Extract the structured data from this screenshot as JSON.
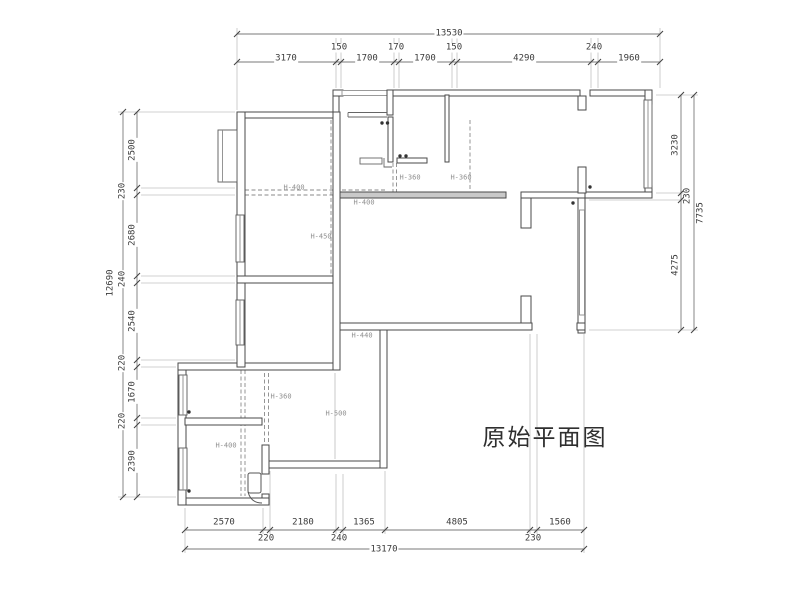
{
  "title": {
    "text": "原始平面图"
  },
  "dimensions": {
    "top": {
      "overall": "13530",
      "segments": [
        "3170",
        "150",
        "1700",
        "170",
        "1700",
        "150",
        "4290",
        "240",
        "1960"
      ]
    },
    "left": {
      "overall": "12690",
      "segments": [
        "2500",
        "230",
        "2680",
        "240",
        "2540",
        "220",
        "1670",
        "220",
        "2390"
      ]
    },
    "right": {
      "overall": "7735",
      "segments": [
        "3230",
        "230",
        "4275"
      ]
    },
    "bottom": {
      "overall": "13170",
      "segments": [
        "2570",
        "220",
        "2180",
        "240",
        "1365",
        "4805",
        "230",
        "1560"
      ]
    }
  },
  "beam_labels": [
    "H-400",
    "H-450",
    "H-360",
    "H-360",
    "H-400",
    "H-440",
    "H-360",
    "H-500",
    "H-400"
  ],
  "colors": {
    "wall_line": "#4a4a4a",
    "dim_line": "#7a7a7a",
    "dim_text": "#3a3a3a",
    "beam_text": "#8f8f8f",
    "wall_fill_light": "#c9c9c9"
  },
  "placed_texts": [
    {
      "t": "13530",
      "x": 449,
      "y": 34,
      "rot": 0,
      "kind": "dim"
    },
    {
      "t": "3170",
      "x": 286,
      "y": 59,
      "rot": 0,
      "kind": "dim"
    },
    {
      "t": "150",
      "x": 339,
      "y": 48,
      "rot": 0,
      "kind": "dim"
    },
    {
      "t": "1700",
      "x": 367,
      "y": 59,
      "rot": 0,
      "kind": "dim"
    },
    {
      "t": "170",
      "x": 396,
      "y": 48,
      "rot": 0,
      "kind": "dim"
    },
    {
      "t": "1700",
      "x": 425,
      "y": 59,
      "rot": 0,
      "kind": "dim"
    },
    {
      "t": "150",
      "x": 454,
      "y": 48,
      "rot": 0,
      "kind": "dim"
    },
    {
      "t": "4290",
      "x": 524,
      "y": 59,
      "rot": 0,
      "kind": "dim"
    },
    {
      "t": "240",
      "x": 594,
      "y": 48,
      "rot": 0,
      "kind": "dim"
    },
    {
      "t": "1960",
      "x": 629,
      "y": 59,
      "rot": 0,
      "kind": "dim"
    },
    {
      "t": "12690",
      "x": 111,
      "y": 283,
      "rot": 1,
      "kind": "dim"
    },
    {
      "t": "2500",
      "x": 133,
      "y": 150,
      "rot": 1,
      "kind": "dim"
    },
    {
      "t": "230",
      "x": 123,
      "y": 191,
      "rot": 1,
      "kind": "dim"
    },
    {
      "t": "2680",
      "x": 133,
      "y": 235,
      "rot": 1,
      "kind": "dim"
    },
    {
      "t": "240",
      "x": 123,
      "y": 279,
      "rot": 1,
      "kind": "dim"
    },
    {
      "t": "2540",
      "x": 133,
      "y": 321,
      "rot": 1,
      "kind": "dim"
    },
    {
      "t": "220",
      "x": 123,
      "y": 363,
      "rot": 1,
      "kind": "dim"
    },
    {
      "t": "1670",
      "x": 133,
      "y": 392,
      "rot": 1,
      "kind": "dim"
    },
    {
      "t": "220",
      "x": 123,
      "y": 421,
      "rot": 1,
      "kind": "dim"
    },
    {
      "t": "2390",
      "x": 133,
      "y": 461,
      "rot": 1,
      "kind": "dim"
    },
    {
      "t": "3230",
      "x": 676,
      "y": 145,
      "rot": 1,
      "kind": "dim"
    },
    {
      "t": "230",
      "x": 688,
      "y": 196,
      "rot": 1,
      "kind": "dim"
    },
    {
      "t": "4275",
      "x": 676,
      "y": 265,
      "rot": 1,
      "kind": "dim"
    },
    {
      "t": "7735",
      "x": 701,
      "y": 213,
      "rot": 1,
      "kind": "dim"
    },
    {
      "t": "2570",
      "x": 224,
      "y": 523,
      "rot": 0,
      "kind": "dim"
    },
    {
      "t": "220",
      "x": 266,
      "y": 539,
      "rot": 0,
      "kind": "dim"
    },
    {
      "t": "2180",
      "x": 303,
      "y": 523,
      "rot": 0,
      "kind": "dim"
    },
    {
      "t": "240",
      "x": 339,
      "y": 539,
      "rot": 0,
      "kind": "dim"
    },
    {
      "t": "1365",
      "x": 364,
      "y": 523,
      "rot": 0,
      "kind": "dim"
    },
    {
      "t": "4805",
      "x": 457,
      "y": 523,
      "rot": 0,
      "kind": "dim"
    },
    {
      "t": "230",
      "x": 533,
      "y": 539,
      "rot": 0,
      "kind": "dim"
    },
    {
      "t": "1560",
      "x": 560,
      "y": 523,
      "rot": 0,
      "kind": "dim"
    },
    {
      "t": "13170",
      "x": 384,
      "y": 550,
      "rot": 0,
      "kind": "dim"
    },
    {
      "t": "H-400",
      "x": 294,
      "y": 188,
      "rot": 0,
      "kind": "beam"
    },
    {
      "t": "H-450",
      "x": 321,
      "y": 237,
      "rot": 0,
      "kind": "beam"
    },
    {
      "t": "H-360",
      "x": 410,
      "y": 178,
      "rot": 0,
      "kind": "beam"
    },
    {
      "t": "H-360",
      "x": 461,
      "y": 178,
      "rot": 0,
      "kind": "beam"
    },
    {
      "t": "H-400",
      "x": 364,
      "y": 203,
      "rot": 0,
      "kind": "beam"
    },
    {
      "t": "H-440",
      "x": 362,
      "y": 336,
      "rot": 0,
      "kind": "beam"
    },
    {
      "t": "H-360",
      "x": 281,
      "y": 397,
      "rot": 0,
      "kind": "beam"
    },
    {
      "t": "H-500",
      "x": 336,
      "y": 414,
      "rot": 0,
      "kind": "beam"
    },
    {
      "t": "H-400",
      "x": 226,
      "y": 446,
      "rot": 0,
      "kind": "beam"
    }
  ]
}
